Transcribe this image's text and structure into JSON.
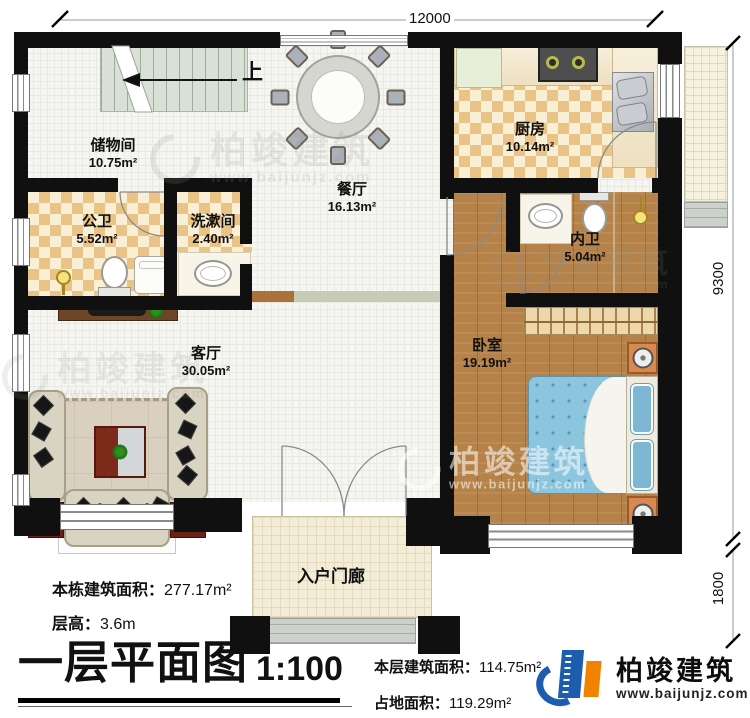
{
  "plan": {
    "title": "一层平面图",
    "scale": "1:100",
    "stairs_up_label": "上",
    "dimensions": {
      "top": "12000",
      "right_main": "9300",
      "right_porch": "1800"
    },
    "rooms": {
      "storage": {
        "name": "储物间",
        "area": "10.75m²"
      },
      "public_bath": {
        "name": "公卫",
        "area": "5.52m²"
      },
      "washroom": {
        "name": "洗漱间",
        "area": "2.40m²"
      },
      "dining": {
        "name": "餐厅",
        "area": "16.13m²"
      },
      "kitchen": {
        "name": "厨房",
        "area": "10.14m²"
      },
      "ensuite_bath": {
        "name": "内卫",
        "area": "5.04m²"
      },
      "bedroom": {
        "name": "卧室",
        "area": "19.19m²"
      },
      "living": {
        "name": "客厅",
        "area": "30.05m²"
      },
      "porch": {
        "name": "入户门廊"
      }
    },
    "stats": {
      "total_area": {
        "label": "本栋建筑面积：",
        "value": "277.17m²"
      },
      "floor_height": {
        "label": "层高：",
        "value": "3.6m"
      },
      "floor_area": {
        "label": "本层建筑面积：",
        "value": "114.75m²"
      },
      "footprint": {
        "label": "占地面积：",
        "value": "119.29m²"
      }
    },
    "brand": {
      "name": "柏竣建筑",
      "url": "www.baijunjz.com"
    },
    "fixtures": [
      "stairs",
      "dining-table",
      "dining-chair",
      "fridge",
      "gas-stove",
      "kitchen-sink",
      "toilet",
      "washing-machine",
      "shower-head",
      "wash-basin",
      "tv-cabinet",
      "sofa",
      "coffee-table",
      "rug",
      "side-table",
      "wardrobe",
      "double-bed",
      "nightstand",
      "entry-double-door",
      "interior-door",
      "window"
    ],
    "colors": {
      "wall": "#101010",
      "tile_checker": "#eac387",
      "tile_light": "#f9efd5",
      "wood_floor": "#b5834a",
      "bed_blue": "#8cc6de",
      "brand_blue": "#1d5dad",
      "brand_orange": "#f08300"
    }
  }
}
